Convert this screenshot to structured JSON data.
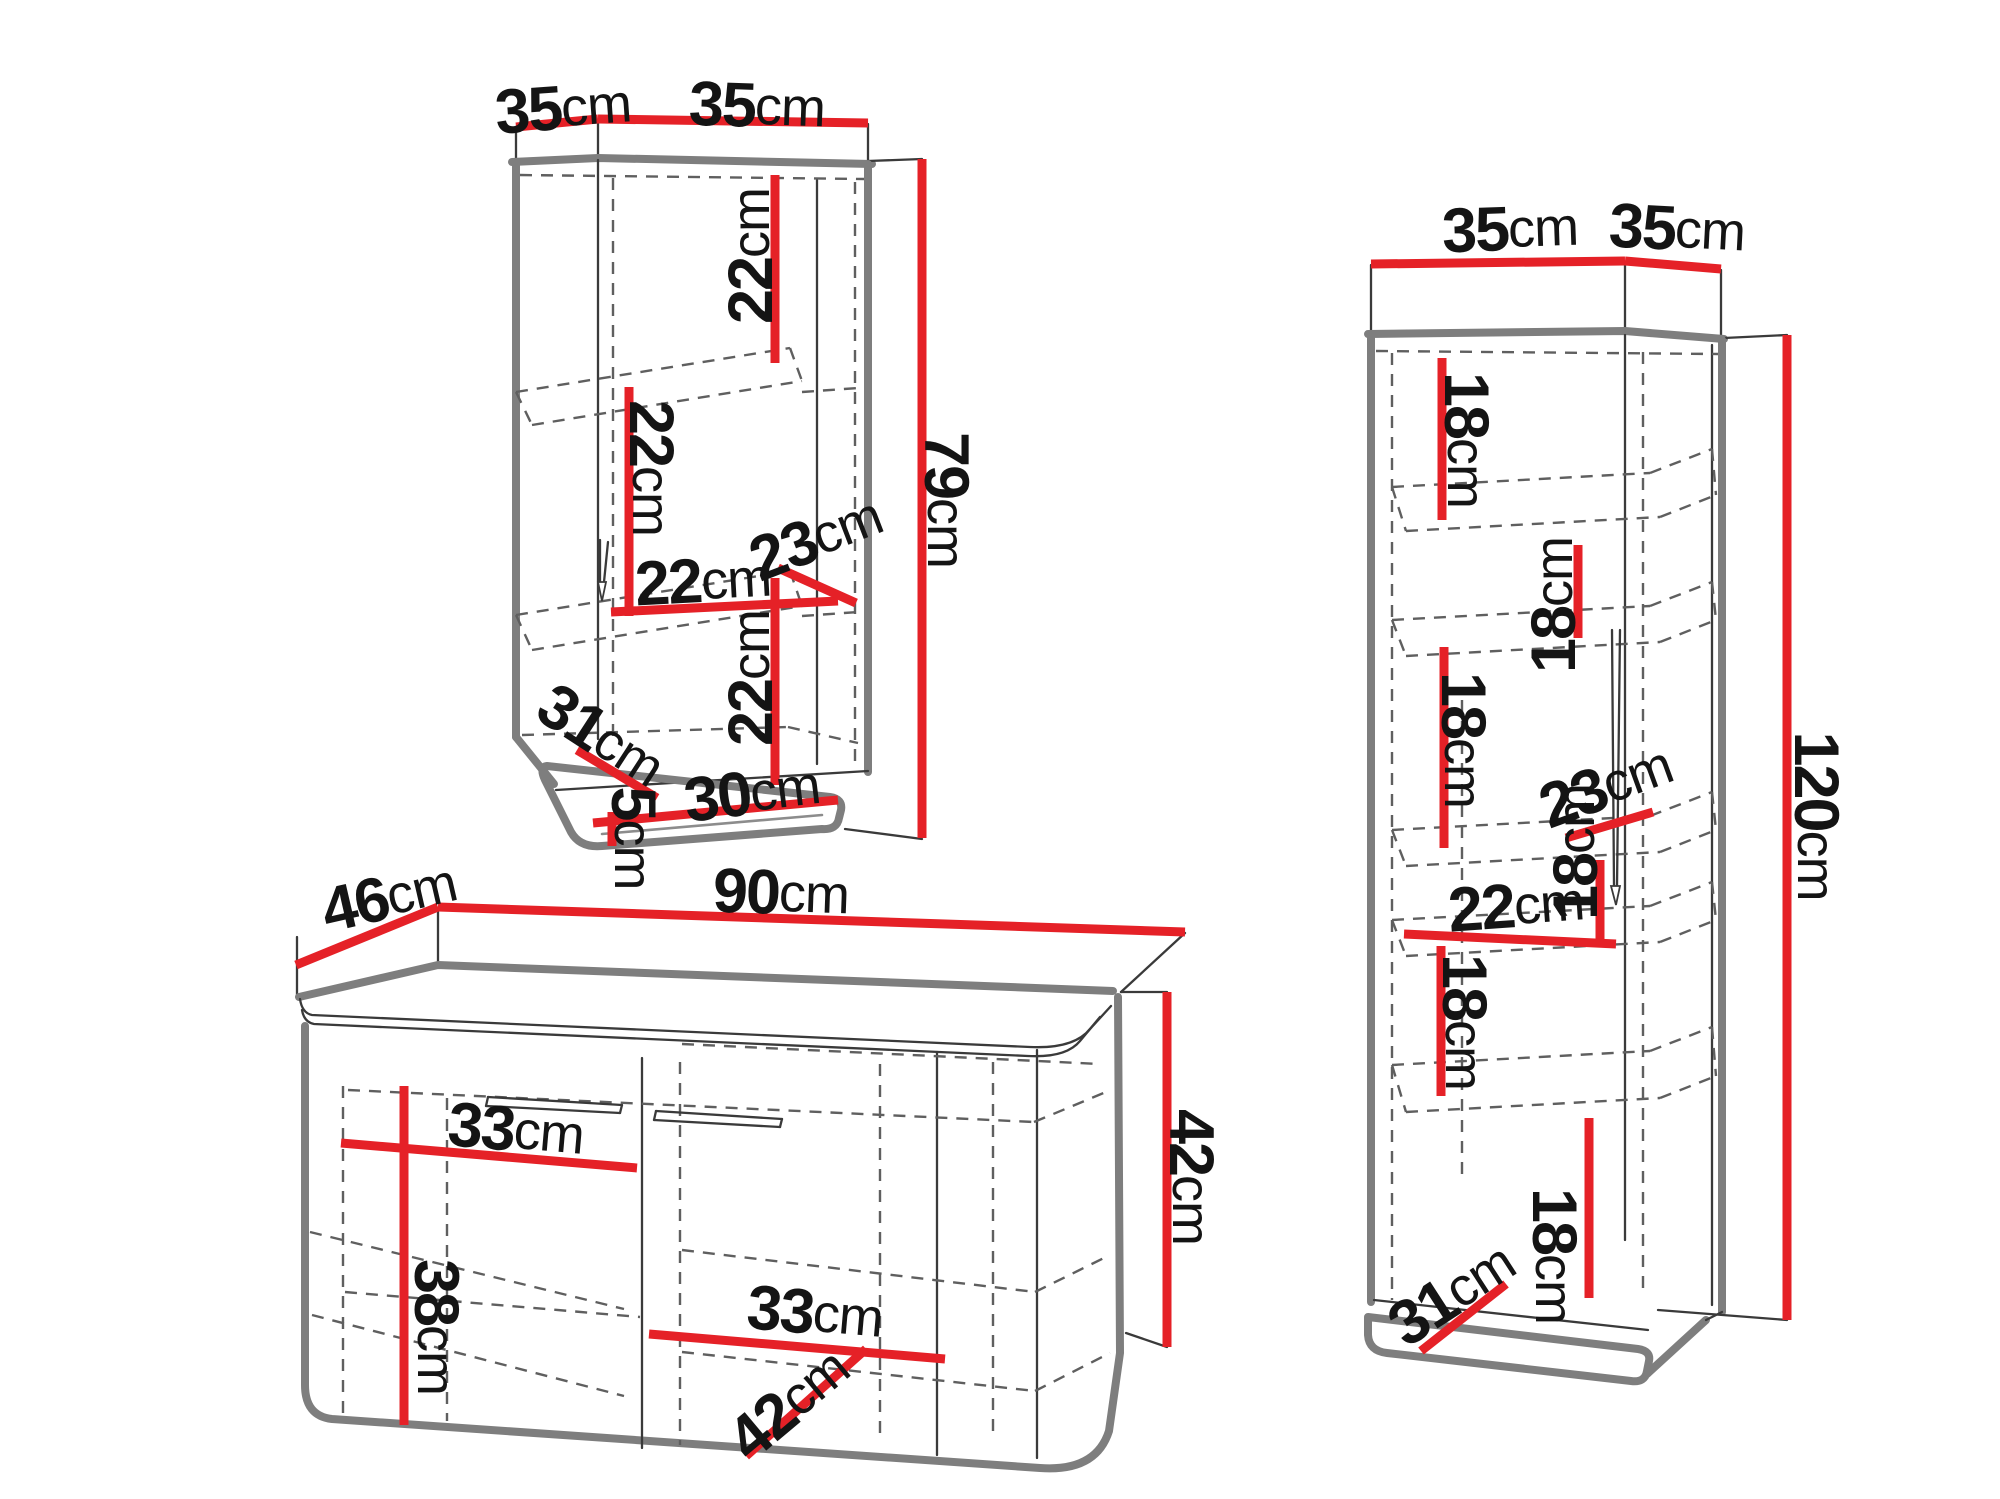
{
  "colors": {
    "background": "#ffffff",
    "dimension_red": "#e52127",
    "outline_gray": "#7e7e7e",
    "text_black": "#141414"
  },
  "wall_cabinet": {
    "top_width_left": {
      "value": "35",
      "unit": "cm"
    },
    "top_width_right": {
      "value": "35",
      "unit": "cm"
    },
    "height": {
      "value": "79",
      "unit": "cm"
    },
    "compartment_top": {
      "value": "22",
      "unit": "cm"
    },
    "compartment_middle": {
      "value": "22",
      "unit": "cm"
    },
    "shelf_width": {
      "value": "22",
      "unit": "cm"
    },
    "shelf_depth": {
      "value": "23",
      "unit": "cm"
    },
    "compartment_bottom": {
      "value": "22",
      "unit": "cm"
    },
    "bottom_diagonal": {
      "value": "31",
      "unit": "cm"
    },
    "bottom_width": {
      "value": "30",
      "unit": "cm"
    },
    "bottom_thickness": {
      "value": "5",
      "unit": "cm"
    }
  },
  "sideboard": {
    "depth": {
      "value": "46",
      "unit": "cm"
    },
    "width": {
      "value": "90",
      "unit": "cm"
    },
    "left_compartment_width": {
      "value": "33",
      "unit": "cm"
    },
    "left_compartment_height": {
      "value": "38",
      "unit": "cm"
    },
    "right_compartment_width": {
      "value": "33",
      "unit": "cm"
    },
    "height": {
      "value": "42",
      "unit": "cm"
    },
    "interior_diagonal": {
      "value": "42",
      "unit": "cm"
    }
  },
  "tall_cabinet": {
    "top_width_left": {
      "value": "35",
      "unit": "cm"
    },
    "top_width_right": {
      "value": "35",
      "unit": "cm"
    },
    "height": {
      "value": "120",
      "unit": "cm"
    },
    "compartment_1": {
      "value": "18",
      "unit": "cm"
    },
    "compartment_2": {
      "value": "18",
      "unit": "cm"
    },
    "compartment_3": {
      "value": "18",
      "unit": "cm"
    },
    "shelf_depth": {
      "value": "23",
      "unit": "cm"
    },
    "compartment_4": {
      "value": "18",
      "unit": "cm"
    },
    "interior_width": {
      "value": "22",
      "unit": "cm"
    },
    "compartment_5": {
      "value": "18",
      "unit": "cm"
    },
    "compartment_6": {
      "value": "18",
      "unit": "cm"
    },
    "bottom_diagonal": {
      "value": "31",
      "unit": "cm"
    }
  }
}
